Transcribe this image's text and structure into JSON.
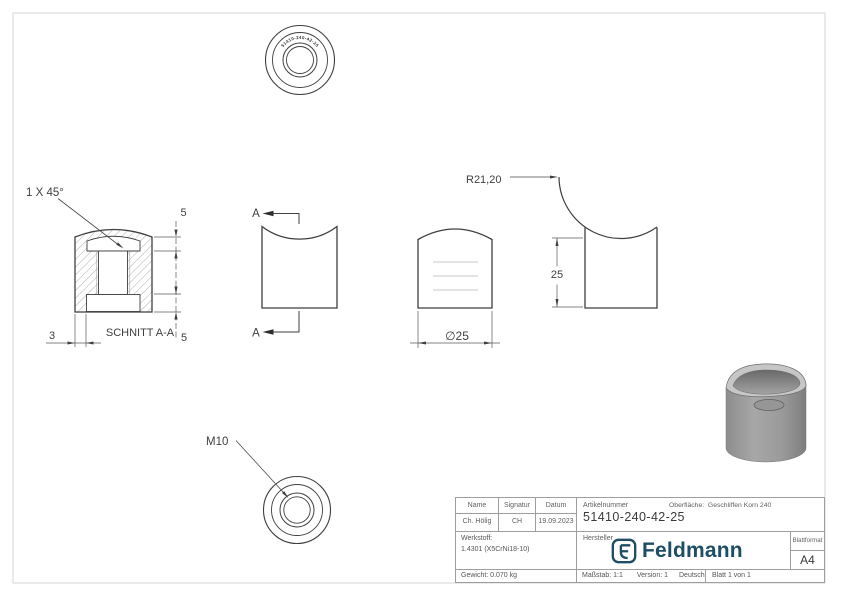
{
  "drawing": {
    "chamfer_note": "1 X 45°",
    "section_title": "SCHNITT A-A",
    "dim_top_5": "5",
    "dim_bottom_5": "5",
    "dim_wall_3": "3",
    "dim_diameter": "∅25",
    "dim_height_25": "25",
    "dim_radius": "R21,20",
    "thread_callout": "M10",
    "section_mark_top": "A",
    "section_mark_bottom": "A",
    "engraving": "51410-240-42-25"
  },
  "title_block": {
    "name_header": "Name",
    "signatur_header": "Signatur",
    "datum_header": "Datum",
    "name": "Ch. Hölig",
    "signatur": "CH",
    "datum": "19.09.2023",
    "werkstoff_label": "Werkstoff:",
    "werkstoff": "1.4301 (X5CrNi18-10)",
    "gewicht": "Gewicht: 0.070 kg",
    "artikelnummer_label": "Artikelnummer",
    "artikelnummer": "51410-240-42-25",
    "oberflaeche_label": "Oberfläche:",
    "oberflaeche": "Geschliffen Korn 240",
    "hersteller_label": "Hersteller",
    "brand": "Feldmann",
    "blattformat_label": "Blattformat",
    "blattformat": "A4",
    "massstab": "Maßstab: 1:1",
    "version": "Version: 1",
    "sprache": "Deutsch",
    "blatt": "Blatt 1 von 1"
  },
  "colors": {
    "brand_blue": "#1d4e66",
    "line": "#3f3f3f",
    "frame_gray": "#d5d5d5",
    "thread_gray": "#c9c9c9",
    "render_gray": "#9a9a9a"
  }
}
